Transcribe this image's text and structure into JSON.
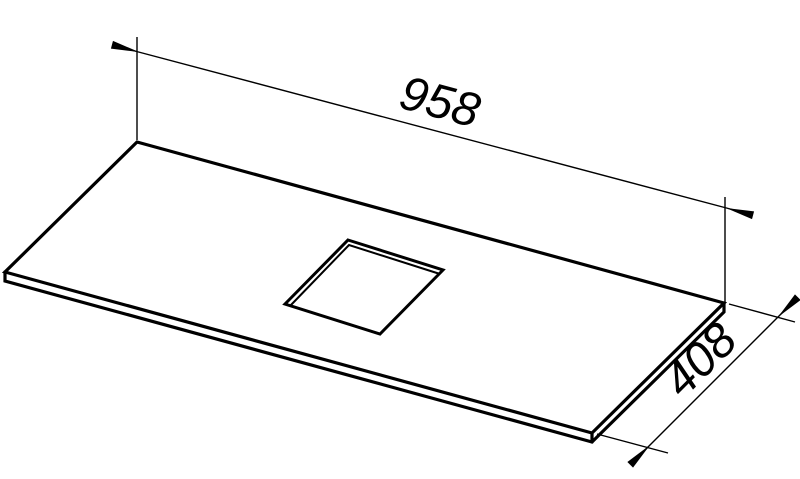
{
  "drawing": {
    "type": "isometric-technical-drawing",
    "subject": "flat panel (countertop) with rectangular center cutout",
    "dimensions": {
      "length": {
        "value": "958"
      },
      "depth": {
        "value": "408"
      }
    },
    "colors": {
      "line": "#000000",
      "background": "#ffffff"
    }
  }
}
